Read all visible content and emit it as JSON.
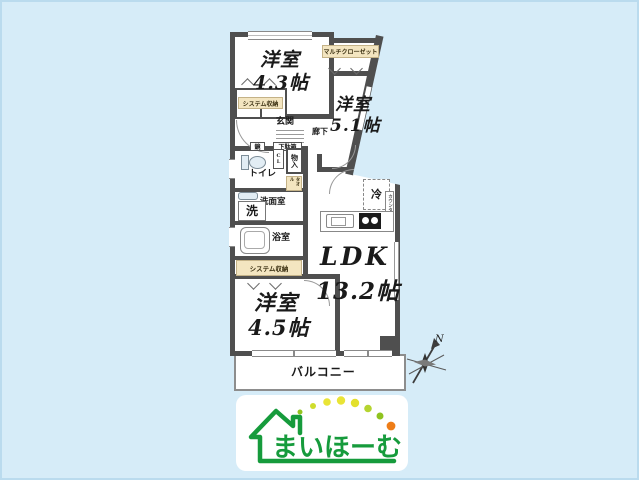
{
  "rooms": {
    "western_43": {
      "name": "洋室",
      "size": "4.3帖"
    },
    "western_51": {
      "name": "洋室",
      "size": "5.1帖"
    },
    "western_45": {
      "name": "洋室",
      "size": "4.5帖"
    },
    "ldk": {
      "name": "LDK",
      "size": "13.2帖"
    }
  },
  "areas": {
    "entrance": "玄関",
    "corridor": "廊下",
    "toilet": "トイレ",
    "washroom": "洗面室",
    "washer": "洗",
    "bathroom": "浴室",
    "balcony": "バルコニー"
  },
  "storage": {
    "multi_closet": "マルチクローゼット",
    "system_storage_top": "システム収納",
    "system_storage_bottom": "システム収納",
    "shoe_box": "下駄箱",
    "mirror": "鏡",
    "closet": "CL",
    "mono_ire": "物入",
    "towel": "タオル"
  },
  "fixtures": {
    "fridge": "冷",
    "counter": "カウンター"
  },
  "compass": {
    "north": "N"
  },
  "logo": {
    "brand": "まいほーむ"
  },
  "colors": {
    "background": "#d6ecf8",
    "wall": "#4f4f4f",
    "closet_label": "#f3e5c0",
    "logo_green": "#169b3c",
    "logo_yellow": "#e9e436",
    "logo_orange": "#ee7d17"
  }
}
